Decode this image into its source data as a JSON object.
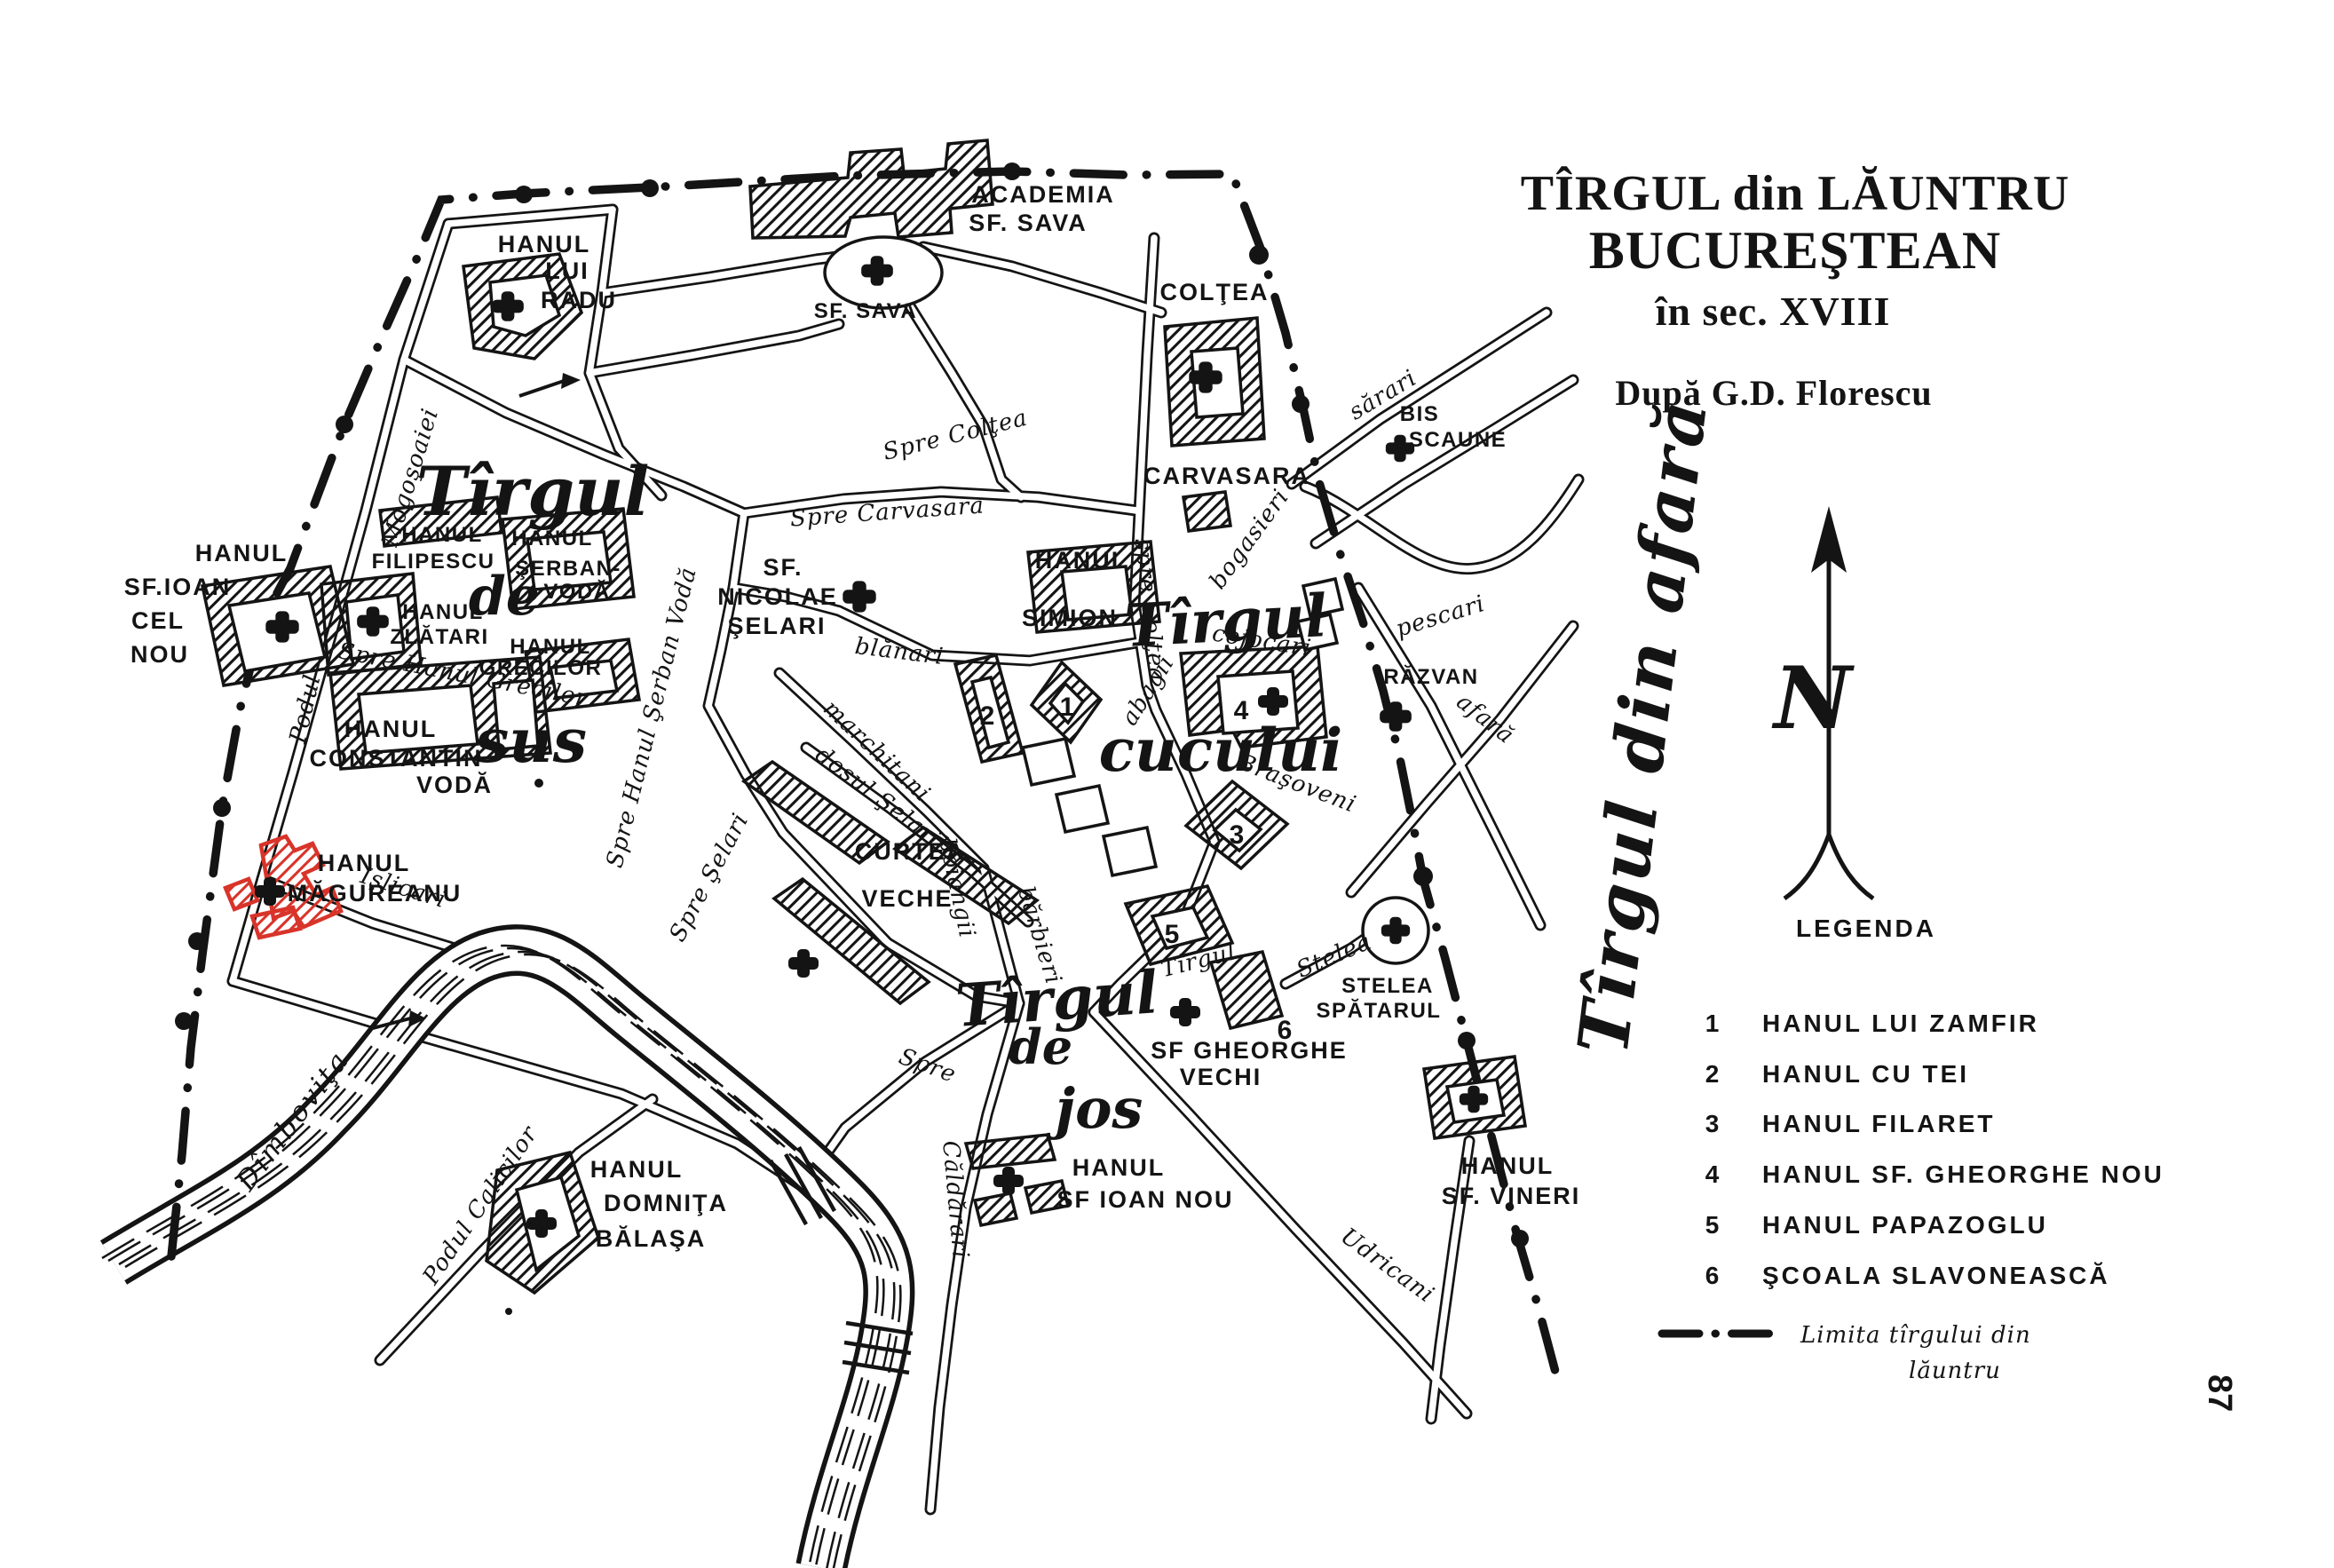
{
  "page": {
    "number": "87"
  },
  "title": {
    "line1": "TÎRGUL din LĂUNTRU",
    "line2": "BUCUREŞTEAN",
    "line3": "în sec. XVIII",
    "credit": "După G.D. Florescu"
  },
  "compass": {
    "label": "N"
  },
  "legend": {
    "heading": "LEGENDA",
    "items": [
      {
        "num": "1",
        "label": "HANUL LUI ZAMFIR"
      },
      {
        "num": "2",
        "label": "HANUL CU TEI"
      },
      {
        "num": "3",
        "label": "HANUL FILARET"
      },
      {
        "num": "4",
        "label": "HANUL SF. GHEORGHE NOU"
      },
      {
        "num": "5",
        "label": "HANUL PAPAZOGLU"
      },
      {
        "num": "6",
        "label": "ŞCOALA SLAVONEASCĂ"
      }
    ],
    "boundary_label": {
      "line1": "Limita tîrgului din",
      "line2": "lăuntru"
    }
  },
  "map": {
    "river": "Dîmboviţa",
    "districts": {
      "sus": [
        "Tîrgul",
        "de",
        "sus"
      ],
      "cucului": [
        "Tîrgul",
        "cucului"
      ],
      "jos": [
        "Tîrgul",
        "de",
        "jos"
      ],
      "afara": "Tîrgul din afară"
    },
    "places": {
      "academia": [
        "ACADEMIA",
        "SF. SAVA"
      ],
      "sf_sava": "SF. SAVA",
      "hanul_radu": [
        "HANUL",
        "LUI",
        "RADU"
      ],
      "coltea": "COLŢEA",
      "carvasara": "CARVASARA",
      "bis_scaune": [
        "BIS",
        "SCAUNE"
      ],
      "razvan": "RĂZVAN",
      "sf_ioan_cel_nou": [
        "HANUL",
        "SF.IOAN",
        "CEL",
        "NOU"
      ],
      "filipescu": [
        "HANUL",
        "FILIPESCU"
      ],
      "serban_voda": [
        "HANUL",
        "ŞERBAN-",
        "VODĂ"
      ],
      "zlatari": [
        "HANUL",
        "ZLĂTARI"
      ],
      "grecilor": [
        "HANUL",
        "GRECILOR"
      ],
      "sf_nicolae_selari": [
        "SF.",
        "NICOLAE",
        "ŞELARI"
      ],
      "simion": [
        "HANUL",
        "SIMION"
      ],
      "constantin_voda": [
        "HANUL",
        "CONSTANTIN",
        "VODĂ"
      ],
      "magureanu": [
        "HANUL",
        "MĂGUREANU"
      ],
      "curtea_veche": [
        "CURTEA",
        "VECHE"
      ],
      "sf_gheorghe_vechi": [
        "SF GHEORGHE",
        "VECHI"
      ],
      "stelea_spatarul": [
        "STELEA",
        "SPĂTARUL"
      ],
      "sf_vineri": [
        "HANUL",
        "SF. VINERI"
      ],
      "sf_ioan_nou": [
        "HANUL",
        "SF IOAN NOU"
      ],
      "domnita_balasa": [
        "HANUL",
        "DOMNIŢA",
        "BĂLAŞA"
      ]
    },
    "streets": {
      "spre_coltea": "Spre Colţea",
      "spre_coltea_v": "spre Colţea",
      "spre_carvasara": "Spre Carvasara",
      "blanari": "blănari",
      "marchitani": "marchitani",
      "dosul_selarilor": "dosul Şelarilor",
      "spre_selari": "Spre Şelari",
      "spre_hanul_serban": "Spre Hanul Şerban Vodă",
      "spre_hanul_grecilor": "Spre Hanul Grecilor",
      "podul_1": "Podul",
      "podul_2": "Mogoşoaiei",
      "islicari": "Işlicari",
      "podul_calicilor": "Podul Calicilor",
      "spre_caldarari_1": "Spre",
      "spre_caldarari_2": "Căldărari",
      "sarari": "sărari",
      "bogasieri": "bogasieri",
      "abagii": "abagii",
      "cojocari": "cojocari",
      "brasoveni": "Braşoveni",
      "boiangii": "boiangii",
      "barbieri": "bărbieri",
      "tirgul": "Tîrgul",
      "stelea": "Stelea",
      "pescari": "pescari",
      "afara": "afară",
      "udricani": "Udricani"
    },
    "numbers": [
      "1",
      "2",
      "3",
      "4",
      "5",
      "6"
    ]
  },
  "colors": {
    "ink": "#141414",
    "red": "#d8342a",
    "paper": "#ffffff"
  }
}
